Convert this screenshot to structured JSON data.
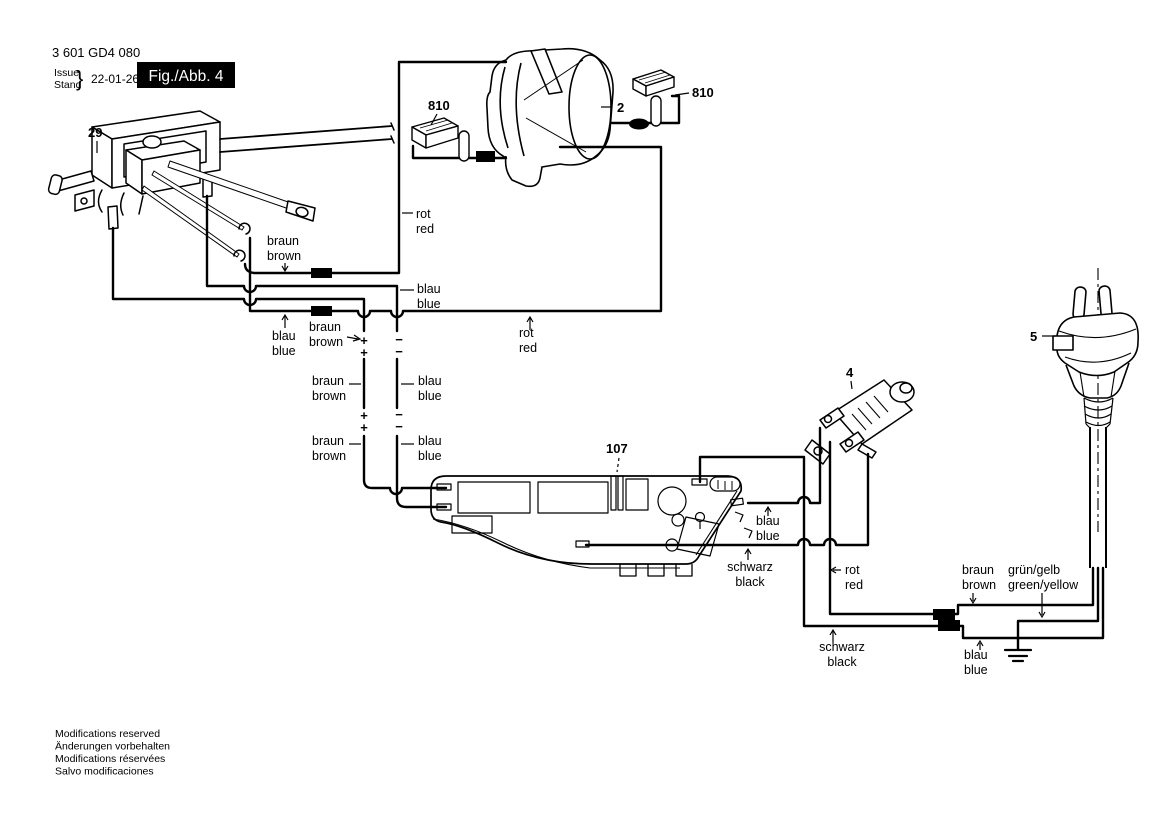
{
  "header": {
    "part_number": "3 601 GD4 080",
    "issue_label": "Issue",
    "stand_label": "Stand",
    "brace": "}",
    "date": "22-01-26",
    "fig_label": "Fig./Abb. 4"
  },
  "callouts": {
    "switch": "29",
    "brush_left": "810",
    "field_coil": "2",
    "brush_right": "810",
    "plug": "5",
    "micro_switch": "4",
    "module": "107"
  },
  "labels": {
    "braun_switch": {
      "l1": "braun",
      "l2": "brown"
    },
    "rot_field_top": {
      "l1": "rot",
      "l2": "red"
    },
    "blau_switch": {
      "l1": "blau",
      "l2": "blue"
    },
    "blau_splice": {
      "l1": "blau",
      "l2": "blue"
    },
    "braun_plus": {
      "l1": "braun",
      "l2": "brown"
    },
    "braun_conn1": {
      "l1": "braun",
      "l2": "brown"
    },
    "blau_conn1": {
      "l1": "blau",
      "l2": "blue"
    },
    "braun_conn2": {
      "l1": "braun",
      "l2": "brown"
    },
    "blau_conn2": {
      "l1": "blau",
      "l2": "blue"
    },
    "rot_splice": {
      "l1": "rot",
      "l2": "red"
    },
    "blau_module": {
      "l1": "blau",
      "l2": "blue"
    },
    "schwarz_module": {
      "l1": "schwarz",
      "l2": "black"
    },
    "rot_switch4": {
      "l1": "rot",
      "l2": "red"
    },
    "schwarz_splice": {
      "l1": "schwarz",
      "l2": "black"
    },
    "braun_cord": {
      "l1": "braun",
      "l2": "brown"
    },
    "gruengelb_cord": {
      "l1": "grün/gelb",
      "l2": "green/yellow"
    },
    "blau_cord": {
      "l1": "blau",
      "l2": "blue"
    }
  },
  "polarity": {
    "plus": "+",
    "minus": "−"
  },
  "footer": {
    "line1": "Modifications reserved",
    "line2": "Änderungen vorbehalten",
    "line3": "Modifications réservées",
    "line4": "Salvo modificaciones"
  },
  "colors": {
    "ink": "#000000",
    "background": "#ffffff"
  }
}
